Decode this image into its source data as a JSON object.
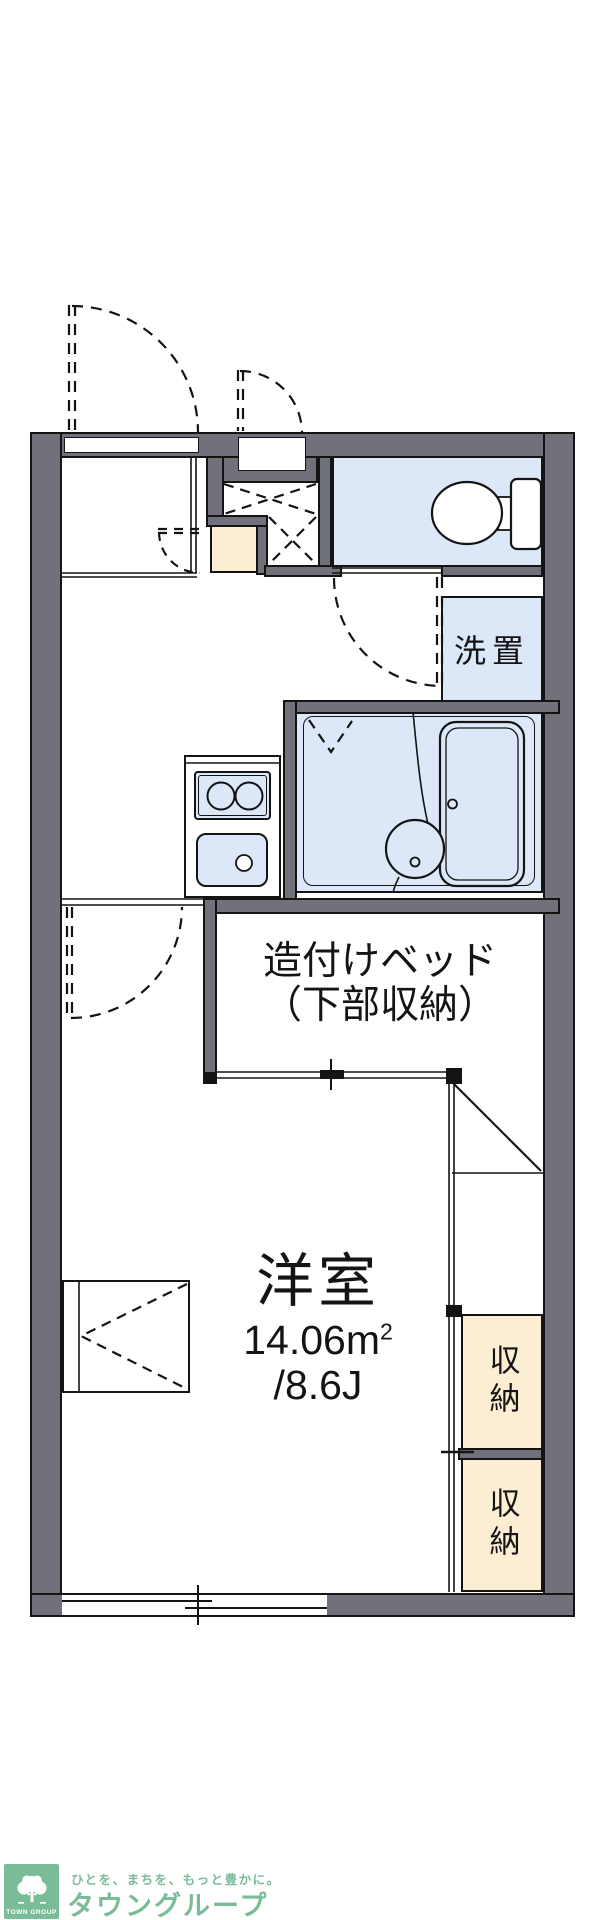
{
  "plan": {
    "rooms": {
      "laundry_label": "洗置",
      "bed_label_line1": "造付けベッド",
      "bed_label_line2": "（下部収納）",
      "main_room_name": "洋室",
      "main_room_area_m2": "14.06m",
      "main_room_area_sup": "2",
      "main_room_area_tatami": "/8.6J",
      "storage_labels": [
        "収納",
        "収納"
      ]
    },
    "colors": {
      "wall_gray": "#71717b",
      "wet_area_blue": "#dce8f7",
      "storage_cream": "#fbeed3",
      "line_black": "#141414",
      "brand_green": "#7abc98"
    },
    "fixtures": [
      "entrance-door-swing",
      "toilet",
      "washing-machine-space",
      "kitchen-stove",
      "kitchen-sink",
      "bathtub",
      "wash-basin",
      "built-in-bed",
      "storage-closets",
      "sliding-window"
    ]
  },
  "footer": {
    "logo_square_text": "TOWN GROUP",
    "tagline": "ひとを、まちを、もっと豊かに。",
    "brand_name": "タウングループ"
  }
}
